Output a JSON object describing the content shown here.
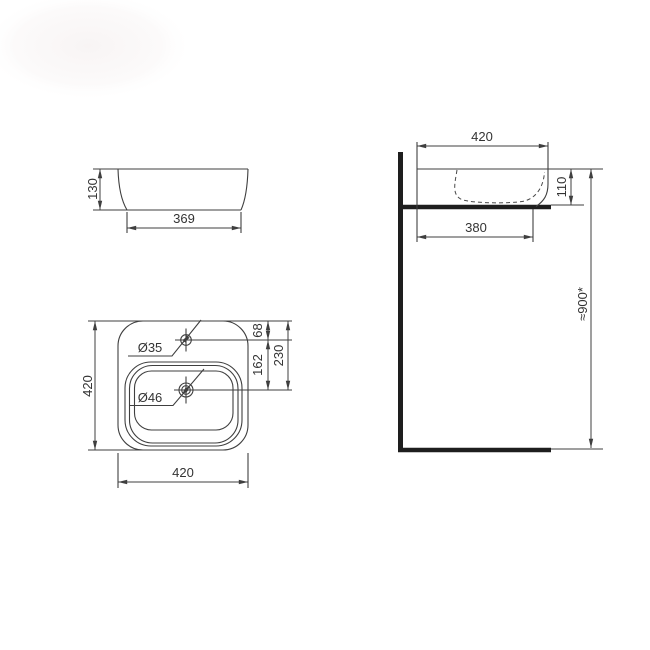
{
  "colors": {
    "background": "#ffffff",
    "line": "#3f3f3f",
    "thick_line": "#1e1e1e",
    "text": "#333333"
  },
  "front_view": {
    "height": "130",
    "base_width": "369"
  },
  "top_view": {
    "depth": "420",
    "width": "420",
    "faucet_hole": "Ø35",
    "drain_hole": "Ø46",
    "edge_to_faucet": "68",
    "faucet_to_drain": "162",
    "edge_to_drain": "230"
  },
  "side_view": {
    "width": "420",
    "basin_height": "110",
    "base_width": "380",
    "height_from_floor": "≈900*"
  }
}
